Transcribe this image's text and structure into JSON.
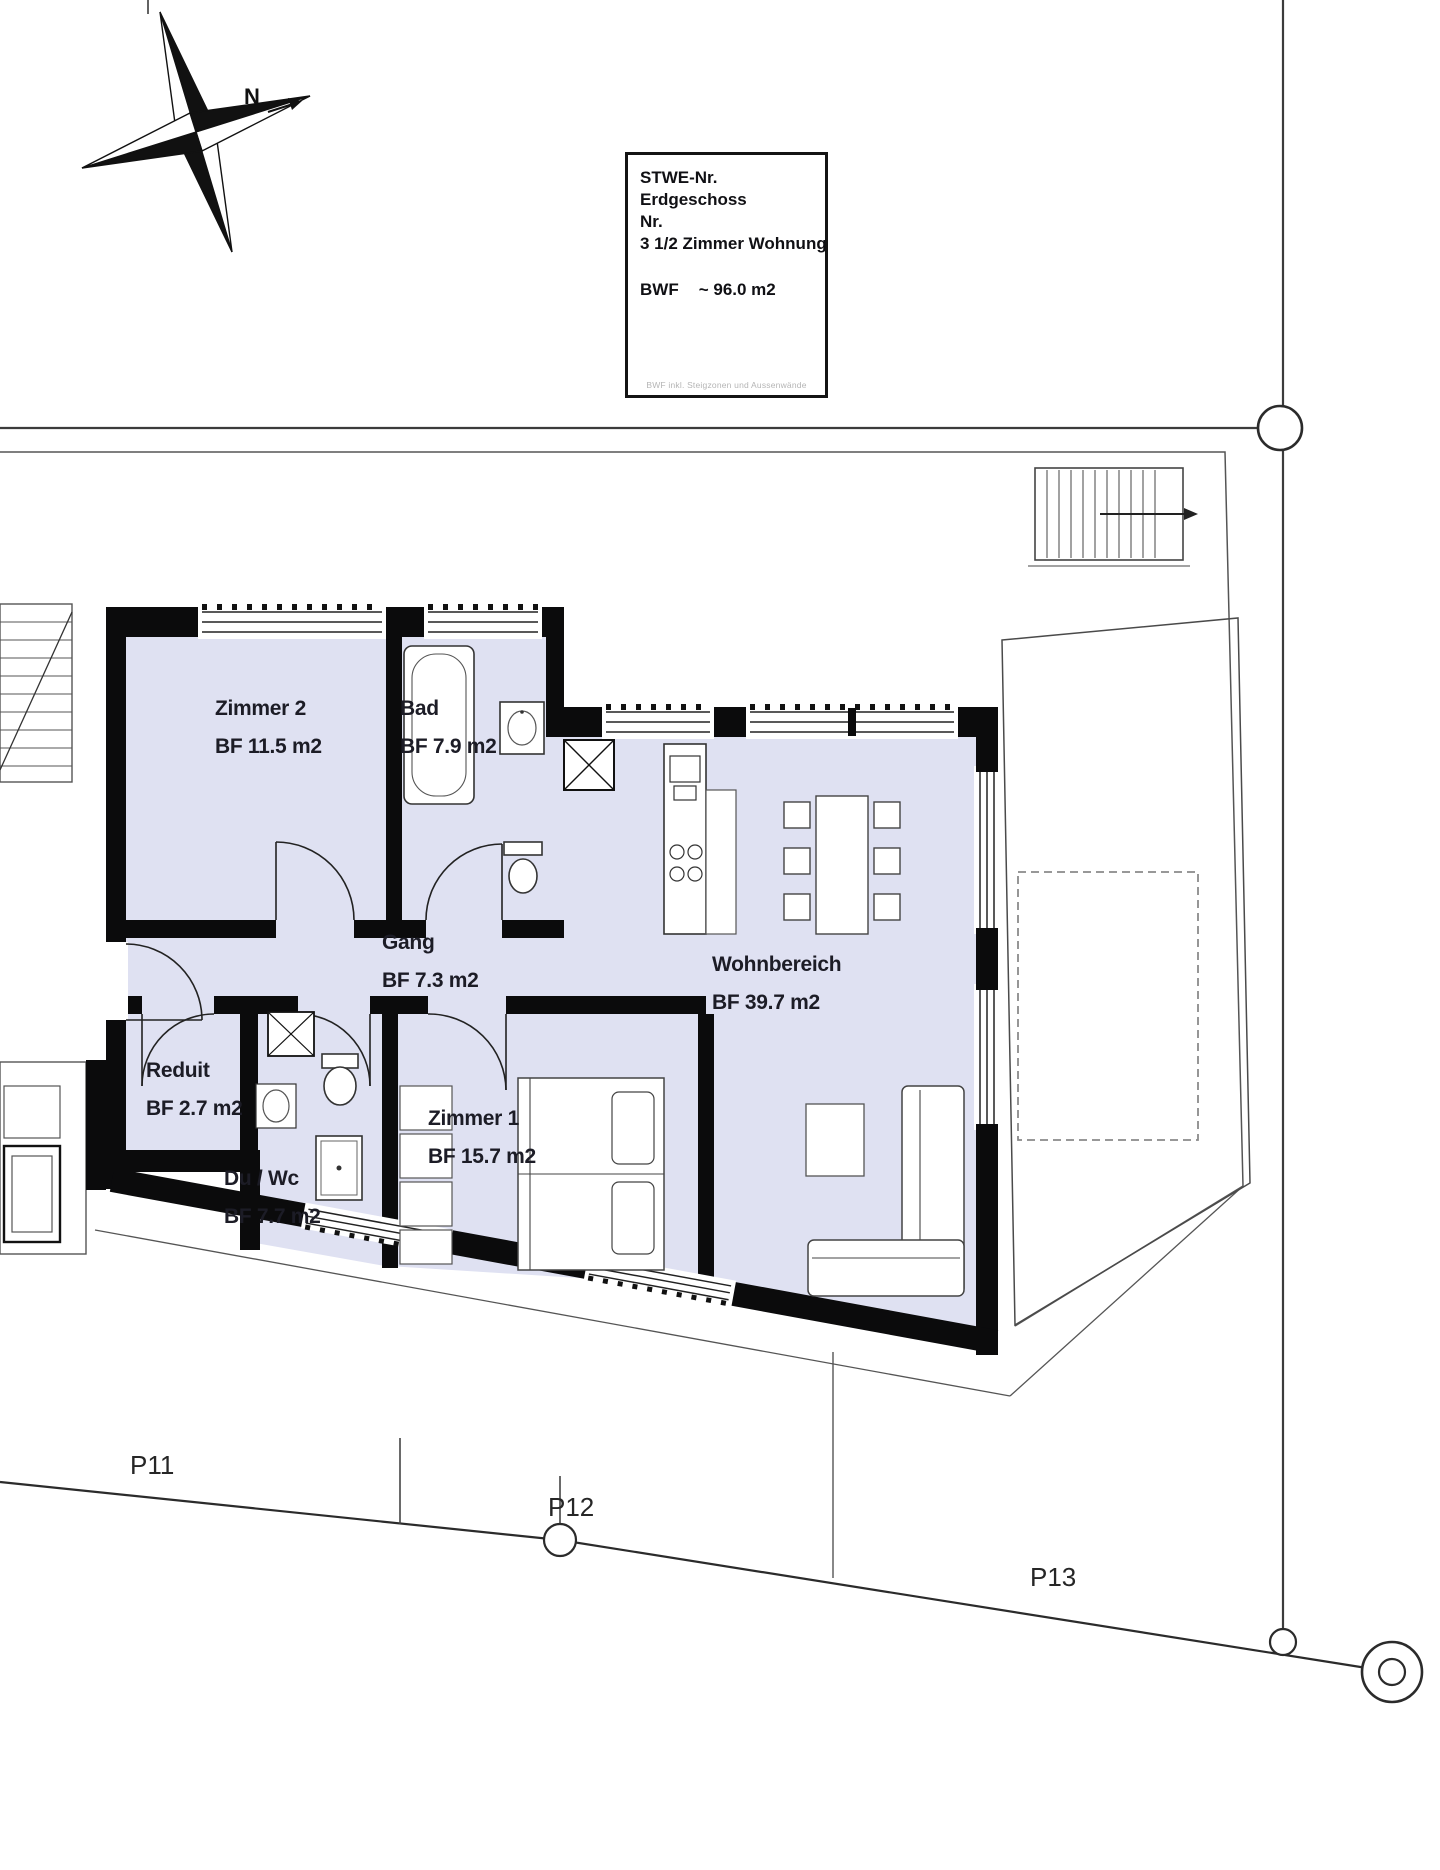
{
  "colors": {
    "room_fill": "#dfe1f2",
    "wall": "#0b0b0c",
    "thin_line": "#3c3c3c",
    "site_line": "#555555",
    "dashed_line": "#8a8a8a",
    "text": "#1c1c26",
    "footnote_text": "#b5b5b5"
  },
  "compass": {
    "north_label": "N"
  },
  "title_box": {
    "stwe_label": "STWE-Nr.",
    "floor": "Erdgeschoss",
    "nr_label": "Nr.",
    "apartment_type": "3 1/2 Zimmer Wohnung",
    "bwf_label": "BWF",
    "bwf_value": "~ 96.0 m2",
    "footnote": "BWF inkl. Steigzonen und Aussenwände"
  },
  "rooms": [
    {
      "name": "Zimmer 2",
      "area": "BF 11.5 m2"
    },
    {
      "name": "Bad",
      "area": "BF 7.9 m2"
    },
    {
      "name": "Gang",
      "area": "BF 7.3 m2"
    },
    {
      "name": "Wohnbereich",
      "area": "BF 39.7 m2"
    },
    {
      "name": "Reduit",
      "area": "BF 2.7 m2"
    },
    {
      "name": "Du / Wc",
      "area": "BF 7.7 m2"
    },
    {
      "name": "Zimmer 1",
      "area": "BF 15.7 m2"
    }
  ],
  "parcels": [
    {
      "label": "P11"
    },
    {
      "label": "P12"
    },
    {
      "label": "P13"
    }
  ]
}
